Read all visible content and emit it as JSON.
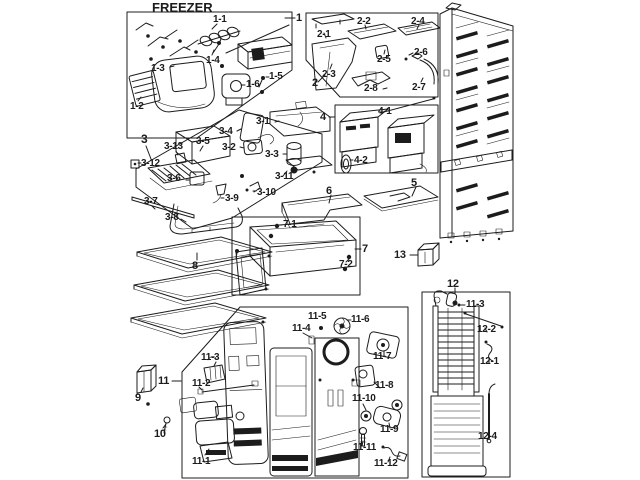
{
  "title": "FREEZER",
  "palette": {
    "ink": "#1c1c1c",
    "paper": "#ffffff"
  },
  "callouts": {
    "box1": {
      "num": "1",
      "parts": [
        "1-1",
        "1-3",
        "1-4",
        "1-2",
        "1-6",
        "1-5"
      ]
    },
    "box2": {
      "num": "2",
      "parts": [
        "2-1",
        "2-2",
        "2-4",
        "2-5",
        "2-6",
        "2-3",
        "2-8",
        "2-7"
      ]
    },
    "box3": {
      "num": "3",
      "parts": [
        "3-1",
        "3-4",
        "3-5",
        "3-2",
        "3-13",
        "3-3",
        "3-12",
        "3-6",
        "3-11",
        "3-10",
        "3-9",
        "3-7",
        "3-8"
      ]
    },
    "box4": {
      "num": "4",
      "parts": [
        "4-1",
        "4-2"
      ]
    },
    "box7": {
      "num": "7",
      "parts": [
        "7-1",
        "7-2"
      ]
    },
    "box11": {
      "num": "11",
      "parts": [
        "11-3",
        "11-2",
        "11-1",
        "11-4",
        "11-5",
        "11-6",
        "11-7",
        "11-8",
        "11-10",
        "11-9",
        "11-11",
        "11-12"
      ]
    },
    "box12": {
      "num": "12",
      "parts": [
        "11-3",
        "12-2",
        "12-1",
        "12-4"
      ]
    },
    "loose": {
      "five": "5",
      "six": "6",
      "eight": "8",
      "nine": "9",
      "ten": "10",
      "thirteen": "13"
    }
  }
}
